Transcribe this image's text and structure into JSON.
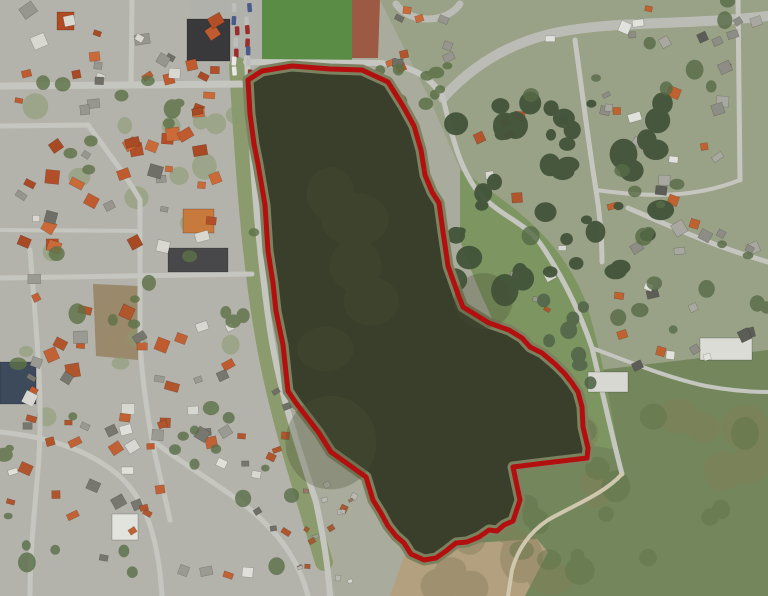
{
  "meta": {
    "width": 768,
    "height": 596,
    "kind": "aerial-photo-with-parcel-overlay"
  },
  "overlay": {
    "name": "red-boundary-polygon",
    "color": "#b30f0f",
    "stroke_width": 5,
    "path": "M248,80 L262,71 L292,66 L330,69 L362,70 L388,82 L403,106 L414,126 L421,150 L425,175 L432,192 L439,203 L443,232 L446,252 L448,266 L459,297 L463,307 L476,315 L489,323 L509,330 L522,338 L530,347 L542,353 L555,364 L565,374 L572,383 L578,392 L582,407 L583,427 L588,448 L587,458 L545,463 L513,467 L517,486 L520,500 L513,521 L504,525 L497,531 L489,530 L479,537 L467,542 L456,543 L446,551 L436,558 L424,560 L411,554 L404,543 L396,536 L388,526 L381,513 L373,500 L366,477 L359,472 L331,452 L319,433 L296,403 L288,391 L283,345 L276,311 L273,283 L268,251 L265,205 L258,164 L254,144 L250,114 Z"
  },
  "map": {
    "base_color": "#a9ac9c",
    "lake": {
      "fill": "#3a3f2b",
      "shore": "#7c8160",
      "shore_width": 11,
      "path": "M248,80 L262,71 L292,66 L330,69 L362,70 L388,82 L403,106 L414,126 L421,150 L425,175 L432,192 L439,203 L443,232 L446,252 L448,266 L459,297 L463,307 L476,315 L489,323 L509,330 L522,338 L530,347 L542,353 L555,364 L565,374 L572,383 L578,392 L582,407 L583,427 L588,448 L587,458 L545,463 L513,467 L517,486 L520,500 L513,521 L504,525 L497,531 L489,530 L479,537 L467,542 L456,543 L446,551 L436,558 L424,560 L411,554 L404,543 L396,536 L388,526 L381,513 L373,500 L366,477 L359,472 L331,452 L319,433 L296,403 L288,391 L283,345 L276,311 L273,283 L268,251 L265,205 L258,164 L254,144 L250,114 Z"
    },
    "areas": [
      {
        "name": "town-block",
        "fill": "#b4b3ab",
        "path": "M0,0 L262,0 L262,85 L252,250 L268,340 L300,470 L335,596 L0,596 Z"
      },
      {
        "name": "northeast-zone",
        "fill": "#99a186",
        "path": "M380,0 L768,0 L768,360 L560,400 L430,100 Z"
      },
      {
        "name": "south-meadow",
        "fill": "#74875c",
        "path": "M430,390 L768,350 L768,596 L392,596 L412,540 Z"
      },
      {
        "name": "east-field",
        "fill": "#7d9560",
        "path": "M460,170 C520,210 560,240 585,300 C600,345 610,400 618,450 L560,440 C520,380 480,300 460,240 Z"
      },
      {
        "name": "sand-flat",
        "fill": "#b2a07e",
        "path": "M390,596 L404,556 L430,545 L472,543 L537,539 L548,552 L525,596 Z"
      },
      {
        "name": "brown-field",
        "fill": "#9a896b",
        "path": "M93,284 L140,286 L138,360 L96,356 Z"
      },
      {
        "name": "football-pitch",
        "fill": "#5b8c45",
        "path": "M262,0 L352,0 L352,62 L262,62 Z"
      },
      {
        "name": "running-track",
        "fill": "#9c5a45",
        "path": "M352,0 L380,0 L378,58 L352,58 Z"
      },
      {
        "name": "parking-lot",
        "fill": "#b1b1ab",
        "path": "M190,0 L262,0 L262,80 L196,80 Z"
      },
      {
        "name": "west-lake-green-band",
        "fill": "none",
        "stroke": "#8c9b6e",
        "sw": 18,
        "path": "M238,66 C244,166 250,256 264,336 C274,396 292,456 310,516 L324,562"
      }
    ],
    "roads": [
      {
        "name": "road-main-north",
        "w": 10,
        "color": "#bcbcb6",
        "d": "M443,98 C470,68 505,45 550,34 C610,20 680,26 768,16"
      },
      {
        "name": "road-roundabout-arc",
        "w": 7,
        "color": "#bcbcb6",
        "d": "M396,4 C410,24 446,24 460,4"
      },
      {
        "name": "road-west-shore",
        "w": 6,
        "color": "#c6c6c0",
        "d": "M247,58 C252,160 257,240 270,330 C280,395 300,452 316,502 C324,540 328,566 330,596"
      },
      {
        "name": "road-pitch-south",
        "w": 6,
        "color": "#c6c6c0",
        "d": "M246,62 L380,63 C415,66 432,78 443,98"
      },
      {
        "name": "road-town-main",
        "w": 7,
        "color": "#c6c6c0",
        "d": "M0,86 L247,84"
      },
      {
        "name": "road-town-v1",
        "w": 5,
        "color": "#c6c6c0",
        "d": "M132,0 L131,84"
      },
      {
        "name": "road-town-h2",
        "w": 5,
        "color": "#c6c6c0",
        "d": "M0,126 L88,125"
      },
      {
        "name": "road-town-diag",
        "w": 5,
        "color": "#c6c6c0",
        "d": "M88,125 C106,150 126,175 140,200"
      },
      {
        "name": "road-town-v2",
        "w": 5,
        "color": "#c6c6c0",
        "d": "M140,200 L140,330 C140,360 145,400 152,440 C158,470 166,500 170,520"
      },
      {
        "name": "road-town-h3",
        "w": 4,
        "color": "#c6c6c0",
        "d": "M0,230 L140,231"
      },
      {
        "name": "road-town-h4",
        "w": 5,
        "color": "#c6c6c0",
        "d": "M0,278 L252,274"
      },
      {
        "name": "road-sw-diag",
        "w": 5,
        "color": "#c6c6c0",
        "d": "M152,440 C190,470 230,490 262,520 C285,542 300,565 308,596"
      },
      {
        "name": "road-left-v",
        "w": 5,
        "color": "#c6c6c0",
        "d": "M30,250 C36,330 44,400 38,470 C34,515 30,555 30,596"
      },
      {
        "name": "road-left-h",
        "w": 5,
        "color": "#c6c6c0",
        "d": "M0,432 C40,436 80,446 112,470 C142,492 158,530 162,596"
      },
      {
        "name": "road-east-lake",
        "w": 5,
        "color": "#c6c6c0",
        "d": "M443,98 C452,135 458,165 478,192 C502,218 526,222 542,246 C562,276 580,312 592,348 C602,390 612,436 622,474"
      },
      {
        "name": "road-east-branch",
        "w": 4,
        "color": "#c6c6c0",
        "d": "M592,348 C630,362 668,378 706,386 C728,390 748,392 768,392"
      },
      {
        "name": "road-right-v1",
        "w": 5,
        "color": "#c6c6c0",
        "d": "M575,40 C582,90 588,140 596,190 C600,215 602,240 602,262"
      },
      {
        "name": "road-right-curve",
        "w": 5,
        "color": "#c6c6c0",
        "d": "M628,208 C668,225 710,245 768,262"
      },
      {
        "name": "road-right-v2",
        "w": 5,
        "color": "#c6c6c0",
        "d": "M738,0 L740,180"
      },
      {
        "name": "road-right-link",
        "w": 4,
        "color": "#c6c6c0",
        "d": "M596,190 C640,196 690,200 740,180"
      },
      {
        "name": "trail-coastal",
        "w": 4,
        "color": "#cfc7ae",
        "d": "M622,474 C604,494 572,506 548,520 C530,532 518,548 512,570 L508,596"
      }
    ],
    "buildings": [
      {
        "name": "sports-hall",
        "x": 187,
        "y": 19,
        "w": 43,
        "h": 42,
        "fill": "#39393b"
      },
      {
        "name": "care-center",
        "x": 183,
        "y": 209,
        "w": 31,
        "h": 24,
        "fill": "#c8793c"
      },
      {
        "name": "school-block",
        "x": 168,
        "y": 248,
        "w": 60,
        "h": 24,
        "fill": "#48484a"
      },
      {
        "name": "blue-building",
        "x": 0,
        "y": 362,
        "w": 36,
        "h": 42,
        "fill": "#3d4a5c"
      },
      {
        "name": "white-building",
        "x": 112,
        "y": 514,
        "w": 26,
        "h": 26,
        "fill": "#e3e3dd"
      },
      {
        "name": "church-building",
        "x": 57,
        "y": 12,
        "w": 17,
        "h": 18,
        "fill": "#b04a22"
      },
      {
        "name": "white-flat-1",
        "x": 700,
        "y": 338,
        "w": 52,
        "h": 22,
        "fill": "#dcdcd6"
      },
      {
        "name": "white-flat-2",
        "x": 588,
        "y": 372,
        "w": 40,
        "h": 20,
        "fill": "#d8d8d2"
      }
    ],
    "cars": {
      "region": [
        229,
        3,
        26,
        74
      ],
      "count": 14,
      "seed": 7,
      "colors": [
        "#e8e8e8",
        "#2e2e2e",
        "#9b2c2c",
        "#4a5a8a",
        "#bdbdbd",
        "#777770"
      ]
    },
    "house_clusters": [
      {
        "name": "houses-old-town",
        "region": [
          8,
          4,
          225,
          250
        ],
        "count": 62,
        "min": 7,
        "max": 15,
        "seed": 1,
        "palette": [
          "#bf5b2e",
          "#c96a38",
          "#a84a24",
          "#96968e",
          "#6f6f68",
          "#d8d8d0",
          "#b34f28"
        ]
      },
      {
        "name": "houses-town-south",
        "region": [
          8,
          262,
          230,
          195
        ],
        "count": 36,
        "min": 7,
        "max": 14,
        "seed": 2,
        "palette": [
          "#bf5b2e",
          "#9a9a93",
          "#b0552c",
          "#77776f",
          "#d8d8d2",
          "#c06236"
        ]
      },
      {
        "name": "houses-southwest",
        "region": [
          0,
          402,
          270,
          185
        ],
        "count": 32,
        "min": 7,
        "max": 13,
        "seed": 3,
        "palette": [
          "#9a9a93",
          "#b0552c",
          "#77776f",
          "#e0e0da",
          "#c06236"
        ]
      },
      {
        "name": "houses-shore-street",
        "region": [
          248,
          382,
          78,
          165
        ],
        "count": 13,
        "min": 6,
        "max": 10,
        "seed": 4,
        "palette": [
          "#9a9a93",
          "#b0552c",
          "#d8d8d2",
          "#6f6f68"
        ]
      },
      {
        "name": "allotment-huts",
        "region": [
          288,
          478,
          74,
          108
        ],
        "count": 16,
        "min": 4,
        "max": 7,
        "seed": 5,
        "palette": [
          "#d5d5cf",
          "#b9b9b1",
          "#997766",
          "#a65a30"
        ]
      },
      {
        "name": "houses-north",
        "region": [
          385,
          2,
          78,
          72
        ],
        "count": 10,
        "min": 6,
        "max": 11,
        "seed": 6,
        "palette": [
          "#b0552c",
          "#96968e",
          "#c96a38",
          "#6f6f68"
        ]
      },
      {
        "name": "houses-east-shore-n",
        "region": [
          472,
          108,
          84,
          110
        ],
        "count": 7,
        "min": 6,
        "max": 11,
        "seed": 8,
        "palette": [
          "#b0552c",
          "#96968e",
          "#d8d8d2"
        ]
      },
      {
        "name": "houses-east-shore-s",
        "region": [
          508,
          232,
          66,
          86
        ],
        "count": 6,
        "min": 6,
        "max": 11,
        "seed": 9,
        "palette": [
          "#b0552c",
          "#96968e",
          "#d8d8d2"
        ]
      },
      {
        "name": "houses-right-north",
        "region": [
          532,
          2,
          234,
          124
        ],
        "count": 22,
        "min": 7,
        "max": 13,
        "seed": 10,
        "palette": [
          "#8d8d86",
          "#5d5d58",
          "#c0622f",
          "#e2e2dc",
          "#a8a8a0"
        ]
      },
      {
        "name": "houses-right-mid",
        "region": [
          600,
          132,
          168,
          190
        ],
        "count": 20,
        "min": 7,
        "max": 13,
        "seed": 11,
        "palette": [
          "#8d8d86",
          "#5d5d58",
          "#c0622f",
          "#e2e2dc",
          "#a8a8a0"
        ]
      },
      {
        "name": "houses-right-low",
        "region": [
          612,
          326,
          156,
          82
        ],
        "count": 8,
        "min": 7,
        "max": 12,
        "seed": 12,
        "palette": [
          "#8d8d86",
          "#5d5d58",
          "#e2e2dc",
          "#c0622f"
        ]
      }
    ],
    "tree_clusters": [
      {
        "name": "garden-green-town",
        "region": [
          10,
          90,
          240,
          330
        ],
        "count": 18,
        "rmin": 6,
        "rmax": 13,
        "fill": "#8a9a70",
        "op": 0.55,
        "seed": 28,
        "layer": "under"
      },
      {
        "name": "meadow-olive-mottle",
        "region": [
          420,
          380,
          348,
          216
        ],
        "count": 26,
        "rmin": 9,
        "rmax": 24,
        "fill": "#837c59",
        "op": 0.4,
        "seed": 25,
        "layer": "under"
      },
      {
        "name": "meadow-dark-mottle",
        "region": [
          460,
          410,
          300,
          180
        ],
        "count": 20,
        "rmin": 6,
        "rmax": 16,
        "fill": "#5f7347",
        "op": 0.45,
        "seed": 26,
        "layer": "under"
      },
      {
        "name": "woods-northeast",
        "region": [
          448,
          102,
          215,
          190
        ],
        "count": 46,
        "rmin": 5,
        "rmax": 14,
        "fill": "#43543a",
        "op": 0.95,
        "seed": 21,
        "layer": "over"
      },
      {
        "name": "trees-east-shore",
        "region": [
          520,
          300,
          90,
          130
        ],
        "count": 12,
        "rmin": 4,
        "rmax": 9,
        "fill": "#53664a",
        "op": 0.9,
        "seed": 22,
        "layer": "over"
      },
      {
        "name": "trees-town",
        "region": [
          0,
          60,
          258,
          400
        ],
        "count": 26,
        "rmin": 4,
        "rmax": 9,
        "fill": "#5d7247",
        "op": 0.8,
        "seed": 23,
        "layer": "over"
      },
      {
        "name": "trees-right",
        "region": [
          530,
          0,
          238,
          330
        ],
        "count": 24,
        "rmin": 4,
        "rmax": 9,
        "fill": "#566b46",
        "op": 0.8,
        "seed": 24,
        "layer": "over"
      },
      {
        "name": "trees-southwest",
        "region": [
          0,
          400,
          300,
          190
        ],
        "count": 16,
        "rmin": 4,
        "rmax": 9,
        "fill": "#5a6f49",
        "op": 0.8,
        "seed": 27,
        "layer": "over"
      },
      {
        "name": "trees-north-band",
        "region": [
          378,
          40,
          80,
          70
        ],
        "count": 10,
        "rmin": 4,
        "rmax": 8,
        "fill": "#5d7247",
        "op": 0.85,
        "seed": 29,
        "layer": "over"
      },
      {
        "name": "lake-shade",
        "region": [
          300,
          130,
          210,
          340
        ],
        "count": 7,
        "rmin": 22,
        "rmax": 48,
        "fill": "#484f33",
        "op": 0.3,
        "seed": 30,
        "layer": "water"
      }
    ]
  }
}
